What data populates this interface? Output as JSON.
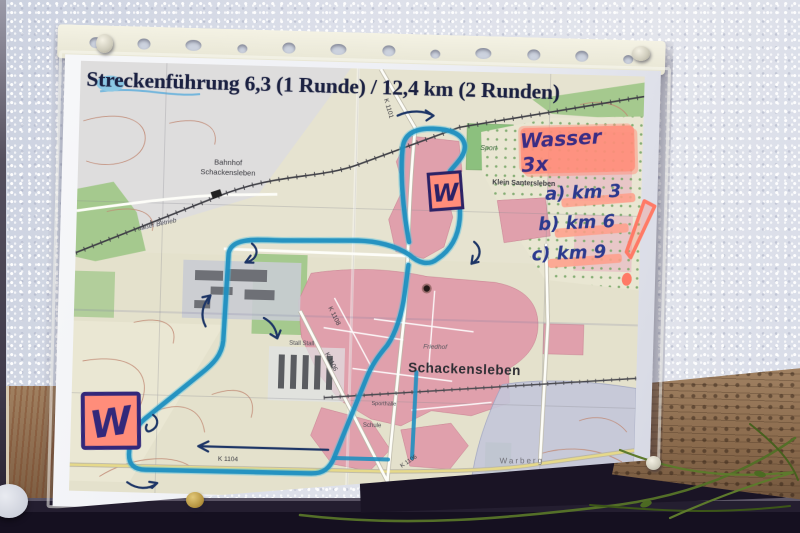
{
  "poster": {
    "title": "Streckenführung 6,3 (1 Runde) / 12,4 km (2 Runden)",
    "handwritten": {
      "water_note": "Wasser 3x",
      "water_points": [
        "a) km 3",
        "b) km 6",
        "c) km 9"
      ],
      "water_marker_north": "W",
      "water_marker_southwest": "W"
    },
    "map_labels": {
      "station_line1": "Bahnhof",
      "station_line2": "Schackensleben",
      "village_northeast": "Klein Santersleben",
      "sport_area": "Sport",
      "town": "Schackensleben",
      "cemetery": "Friedhof",
      "hill_southeast": "Warberg",
      "railway_status": "außer Betrieb",
      "barns": "Stall Stall",
      "school": "Schule",
      "sports_hall": "Sporthalle",
      "roads": {
        "k1101": "K 1101",
        "k1104": "K 1104",
        "k1106": "K 1106",
        "k1108": "K 1108"
      }
    },
    "colors": {
      "route_marker": "#1f8fc0",
      "highlighter_pink": "#ff8d7a",
      "handwriting_ink": "#33308a",
      "built_up_pink": "#e0a0ac",
      "vegetation_green": "#a5c98e",
      "map_base_cream": "#e6e3d0"
    }
  }
}
